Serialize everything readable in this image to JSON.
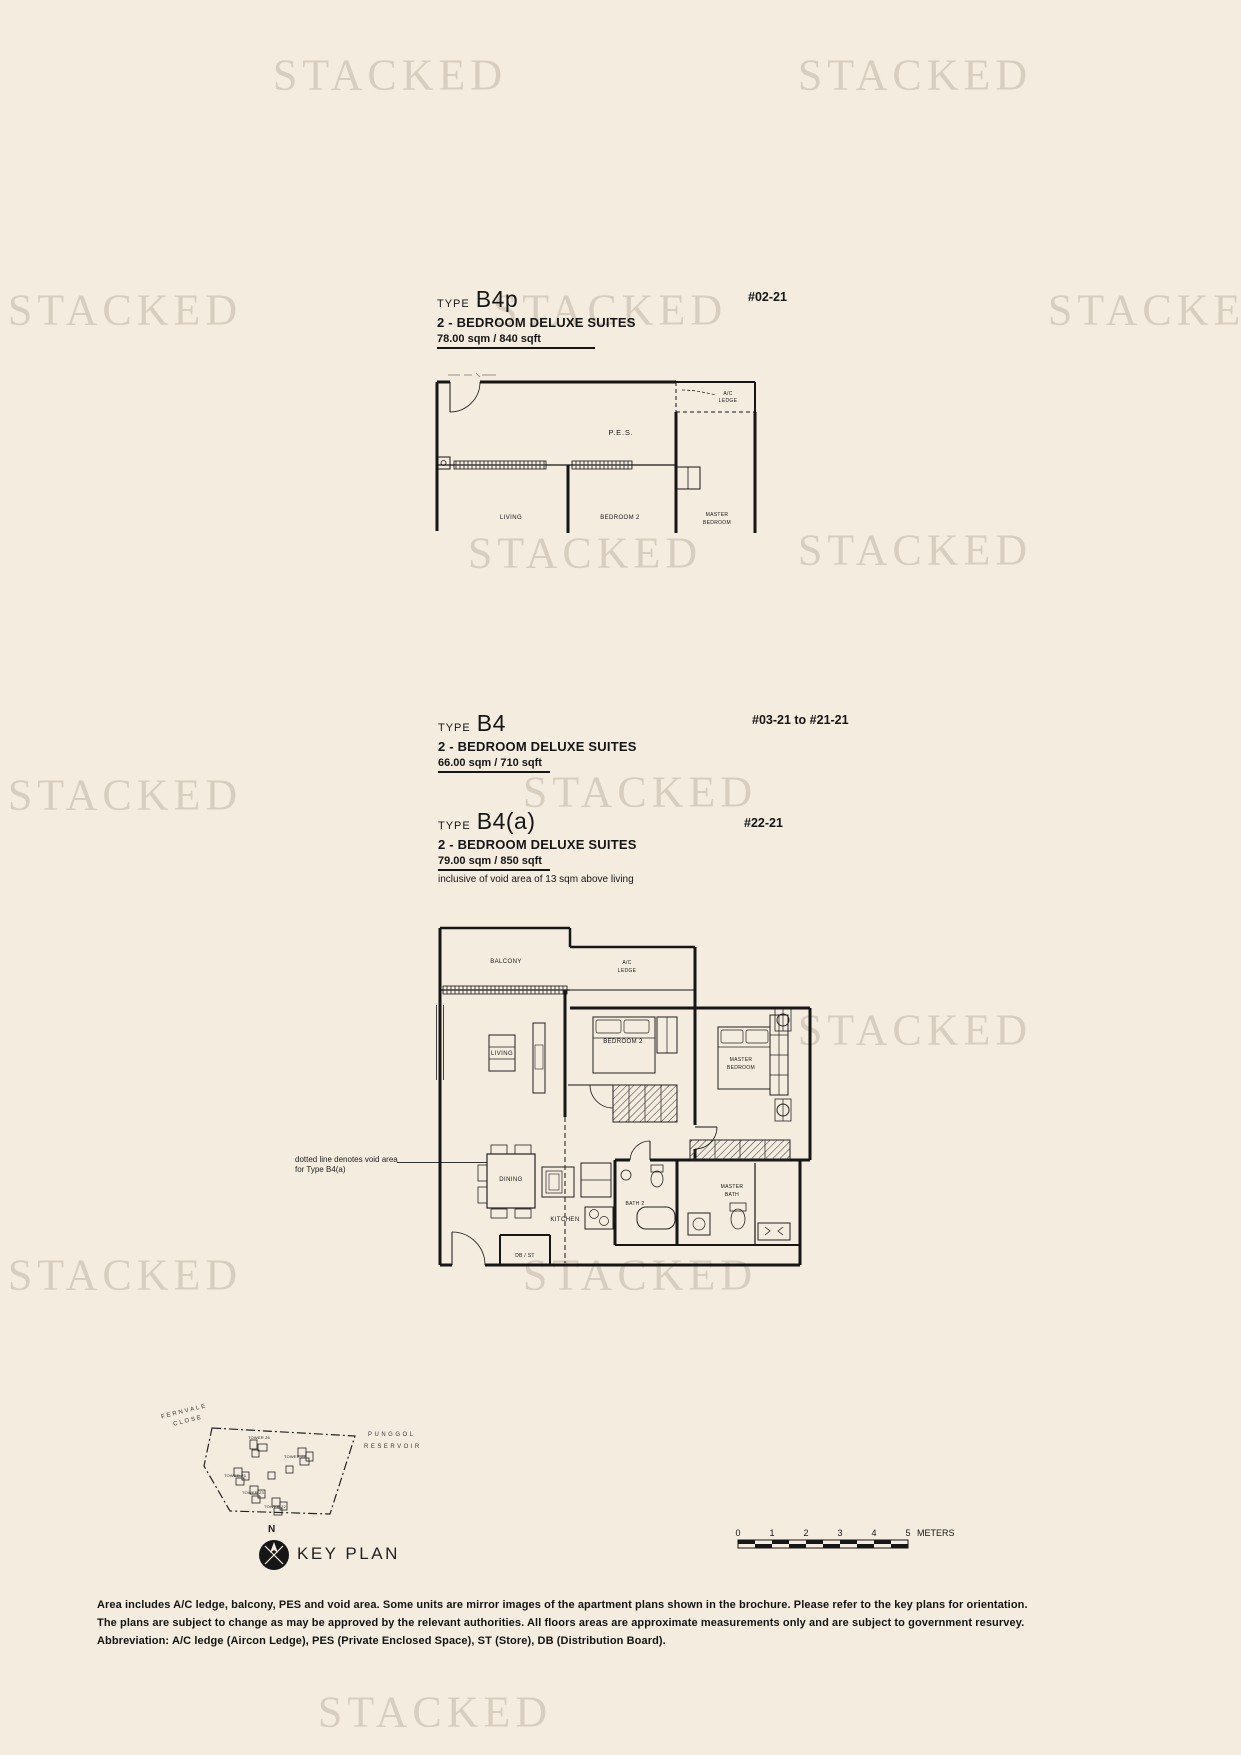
{
  "page": {
    "watermark": "STACKED",
    "background": "#f4ecdf"
  },
  "unit_blocks": [
    {
      "type_label": "TYPE",
      "type_name": "B4p",
      "description": "2 - BEDROOM DELUXE SUITES",
      "area": "78.00 sqm / 840 sqft",
      "unit_range": "#02-21"
    },
    {
      "type_label": "TYPE",
      "type_name": "B4",
      "description": "2 - BEDROOM DELUXE SUITES",
      "area": "66.00 sqm / 710 sqft",
      "unit_range": "#03-21 to #21-21"
    },
    {
      "type_label": "TYPE",
      "type_name": "B4(a)",
      "description": "2 - BEDROOM DELUXE SUITES",
      "area": "79.00 sqm / 850 sqft",
      "area_note": "inclusive of void area of 13 sqm above living",
      "unit_range": "#22-21"
    }
  ],
  "small_plan": {
    "labels": {
      "pes": "P.E.S.",
      "ac_1": "A/C",
      "ac_2": "LEDGE",
      "living": "LIVING",
      "bedroom2": "BEDROOM 2",
      "master_1": "MASTER",
      "master_2": "BEDROOM"
    }
  },
  "large_plan": {
    "labels": {
      "balcony": "BALCONY",
      "ac_1": "A/C",
      "ac_2": "LEDGE",
      "living": "LIVING",
      "bedroom2": "BEDROOM 2",
      "master_1": "MASTER",
      "master_2": "BEDROOM",
      "dining": "DINING",
      "kitchen": "KITCHEN",
      "bath2": "BATH 2",
      "mbath_1": "MASTER",
      "mbath_2": "BATH",
      "dbst": "DB / ST"
    },
    "void_note_1": "dotted line denotes void area",
    "void_note_2": "for Type B4(a)"
  },
  "key_plan": {
    "title": "KEY PLAN",
    "north": "N",
    "road_1": "FERNVALE",
    "road_2": "CLOSE",
    "water_1": "PUNGGOL",
    "water_2": "RESERVOIR",
    "towers": [
      {
        "label": "TOWER 26"
      },
      {
        "label": "TOWER 27"
      },
      {
        "label": "TOWER 25"
      },
      {
        "label": "TOWER 23"
      },
      {
        "label": "TOWER 22"
      }
    ]
  },
  "scale_bar": {
    "ticks": [
      "0",
      "1",
      "2",
      "3",
      "4",
      "5"
    ],
    "unit": "METERS"
  },
  "disclaimer": {
    "lines": [
      "Area includes A/C ledge, balcony, PES and void area.  Some units are mirror images of the apartment plans shown in the brochure. Please refer to the key plans for orientation.",
      "The plans are subject to change as may be approved by the relevant authorities.  All floors areas are approximate measurements only and are subject to government resurvey.",
      "Abbreviation: A/C ledge (Aircon Ledge), PES (Private Enclosed Space), ST (Store), DB (Distribution Board)."
    ]
  }
}
